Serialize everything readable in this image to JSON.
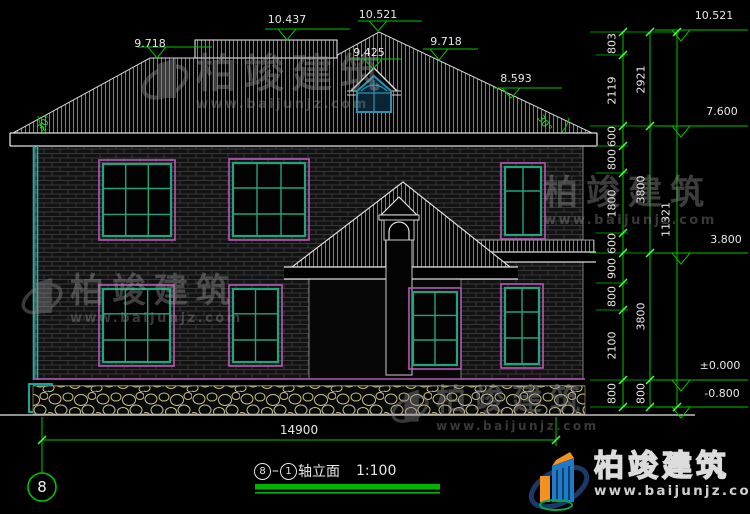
{
  "drawing": {
    "title": {
      "axis_from": "8",
      "axis_to": "1",
      "name": "轴立面",
      "scale": "1:100"
    },
    "axis_bubble": "8",
    "top_levels": {
      "left_eave": "9.718",
      "ridge": "10.437",
      "peak": "10.521",
      "dormer": "9.425",
      "slope_break": "9.718",
      "roof_low": "8.593"
    },
    "right_levels": {
      "top": "10.521",
      "eave": "7.600",
      "floor2": "3.800",
      "zero": "±0.000",
      "ground": "-0.800"
    },
    "angles": {
      "left": "30°",
      "right": "30°"
    },
    "dims": {
      "bottom_width": "14900",
      "right_inner": [
        "803",
        "2119",
        "600",
        "800",
        "1800",
        "600",
        "900",
        "800",
        "2100",
        "800"
      ],
      "right_mid": [
        "2921",
        "3800",
        "3800",
        "800"
      ],
      "right_outer": "11321"
    }
  },
  "watermark": {
    "cn": "柏竣建筑",
    "url": "www.baijunjz.com"
  },
  "logo": {
    "cn": "柏竣建筑",
    "url": "www.baijunjz.com"
  },
  "colors": {
    "dim_green": "#00c400",
    "window_teal": "#21a47e",
    "frame_magenta": "#b558b5",
    "logo_blue": "#1e7bc8",
    "logo_orange": "#f59120",
    "logo_green": "#00a651"
  }
}
